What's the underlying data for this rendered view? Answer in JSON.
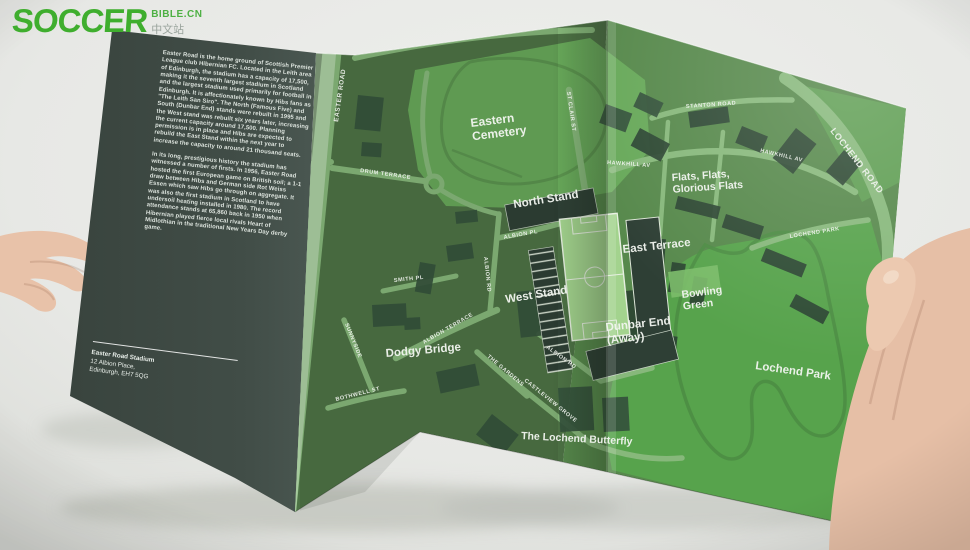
{
  "logo": {
    "title": "SOCCER",
    "suffix": "BIBLE.CN",
    "subtitle": "中文站"
  },
  "panel": {
    "paragraph1": "Easter Road is the home ground of Scottish Premier League club Hibernian FC. Located in the Leith area of Edinburgh, the stadium has a capacity of 17,500, making it the seventh largest stadium in Scotland and the largest stadium used primarily for football in Edinburgh. It is affectionately known by Hibs fans as \"The Leith San Siro\". The North (Famous Five) and South (Dunbar End) stands were rebuilt in 1995 and the West stand was rebuilt six years later, increasing the current capacity around 17,500. Planning permission is in place and Hibs are expected to rebuild the East Stand within the next year to increase the capacity to around 21 thousand seats.",
    "paragraph2": "In its long, prestigious history the stadium has witnessed a number of firsts. In 1956, Easter Road hosted the first European game on British soil; a 1-1 draw between Hibs and German side Rot Weiss Essen which saw Hibs go through on aggregate. It was also the first stadium in Scotland to have undersoil heating installed in 1980. The record attendance stands at 65,860 back in 1950 when Hibernian played fierce local rivals Heart of Midlothian in the traditional New Years Day derby game.",
    "address_name": "Easter Road Stadium",
    "address_line1": "12 Albion Place,",
    "address_line2": "Edinburgh, EH7 5QG"
  },
  "map": {
    "labels": [
      {
        "id": "eastern-cemetery",
        "text": "Eastern\nCemetery",
        "x": 471,
        "y": 127,
        "rot": -7,
        "size": 12,
        "kind": "place"
      },
      {
        "id": "north-stand",
        "text": "North Stand",
        "x": 514,
        "y": 208,
        "rot": -9,
        "size": 11.5,
        "kind": "place"
      },
      {
        "id": "east-terrace",
        "text": "East Terrace",
        "x": 623,
        "y": 253,
        "rot": -6,
        "size": 11.5,
        "kind": "place"
      },
      {
        "id": "west-stand",
        "text": "West Stand",
        "x": 506,
        "y": 303,
        "rot": -9,
        "size": 11.5,
        "kind": "place"
      },
      {
        "id": "dunbar-end",
        "text": "Dunbar End\n(Away)",
        "x": 606,
        "y": 331,
        "rot": -6,
        "size": 11.5,
        "kind": "place"
      },
      {
        "id": "bowling-green",
        "text": "Bowling\nGreen",
        "x": 682,
        "y": 298,
        "rot": -7,
        "size": 10.5,
        "kind": "place"
      },
      {
        "id": "flats",
        "text": "Flats, Flats,\nGlorious Flats",
        "x": 672,
        "y": 181,
        "rot": -4,
        "size": 10.5,
        "kind": "place"
      },
      {
        "id": "lochend-park-area",
        "text": "Lochend Park",
        "x": 755,
        "y": 369,
        "rot": 8,
        "size": 11.5,
        "kind": "place"
      },
      {
        "id": "dodgy-bridge",
        "text": "Dodgy Bridge",
        "x": 386,
        "y": 357,
        "rot": -5,
        "size": 11.5,
        "kind": "place"
      },
      {
        "id": "lochend-butterfly",
        "text": "The Lochend Butterfly",
        "x": 521,
        "y": 439,
        "rot": 3,
        "size": 10.5,
        "kind": "place"
      },
      {
        "id": "easter-road-n",
        "text": "EASTER ROAD",
        "x": 338,
        "y": 122,
        "rot": -82,
        "size": 6.5,
        "kind": "street"
      },
      {
        "id": "easter-road-s",
        "text": "EASTER ROAD",
        "x": 291,
        "y": 358,
        "rot": -76,
        "size": 6.5,
        "kind": "street"
      },
      {
        "id": "drum-terrace",
        "text": "DRUM TERRACE",
        "x": 360,
        "y": 172,
        "rot": 8,
        "size": 5.5,
        "kind": "street"
      },
      {
        "id": "st-clair-st",
        "text": "ST CLAIR ST",
        "x": 567,
        "y": 92,
        "rot": 82,
        "size": 5.5,
        "kind": "street"
      },
      {
        "id": "albion-pl",
        "text": "ALBION PL",
        "x": 504,
        "y": 239,
        "rot": -10,
        "size": 5.5,
        "kind": "street"
      },
      {
        "id": "albion-rd-w",
        "text": "ALBION RD",
        "x": 484,
        "y": 257,
        "rot": 84,
        "size": 5.5,
        "kind": "street"
      },
      {
        "id": "smith-pl",
        "text": "SMITH PL",
        "x": 394,
        "y": 282,
        "rot": -6,
        "size": 5.5,
        "kind": "street"
      },
      {
        "id": "albion-terrace",
        "text": "ALBION TERRACE",
        "x": 424,
        "y": 344,
        "rot": -30,
        "size": 5.5,
        "kind": "street"
      },
      {
        "id": "sunnyside",
        "text": "SUNNYSIDE",
        "x": 345,
        "y": 324,
        "rot": 68,
        "size": 5.5,
        "kind": "street"
      },
      {
        "id": "bothwell-st",
        "text": "BOTHWELL ST",
        "x": 336,
        "y": 401,
        "rot": -14,
        "size": 5.5,
        "kind": "street"
      },
      {
        "id": "the-gardens",
        "text": "THE GARDENS",
        "x": 487,
        "y": 357,
        "rot": 40,
        "size": 5.5,
        "kind": "street"
      },
      {
        "id": "castleview-grove",
        "text": "CASTLEVIEW GROVE",
        "x": 524,
        "y": 381,
        "rot": 39,
        "size": 5.5,
        "kind": "street"
      },
      {
        "id": "albion-rd-se",
        "text": "ALBION RD",
        "x": 546,
        "y": 348,
        "rot": 36,
        "size": 5.5,
        "kind": "street"
      },
      {
        "id": "stanton-road",
        "text": "STANTON ROAD",
        "x": 686,
        "y": 108,
        "rot": -4,
        "size": 5.5,
        "kind": "street"
      },
      {
        "id": "hawkhill-av-e",
        "text": "HAWKHILL AV",
        "x": 760,
        "y": 152,
        "rot": 13,
        "size": 5.5,
        "kind": "street"
      },
      {
        "id": "hawkhill-av-w",
        "text": "HAWKHILL AV",
        "x": 607,
        "y": 164,
        "rot": 4,
        "size": 5.5,
        "kind": "street"
      },
      {
        "id": "lochend-road",
        "text": "LOCHEND ROAD",
        "x": 830,
        "y": 131,
        "rot": 52,
        "size": 9,
        "ls": 1.5,
        "kind": "street"
      },
      {
        "id": "lochend-park-st",
        "text": "LOCHEND PARK",
        "x": 790,
        "y": 238,
        "rot": -9,
        "size": 5.5,
        "kind": "street"
      }
    ]
  },
  "colors": {
    "logo_green": "#3fae2e",
    "paper_panel": "#404c46",
    "map_base": "#4d7245",
    "map_base_bright": "#57894c",
    "park_green": "#57a34c",
    "cemetery_green": "#68a95a",
    "road_green": "#87b87b",
    "pitch_green": "#a3d38e",
    "stand_dark": "#2e3f35",
    "label_white": "#ffffff",
    "backdrop": "#e9eae7",
    "skin": "#e6bfa7"
  }
}
